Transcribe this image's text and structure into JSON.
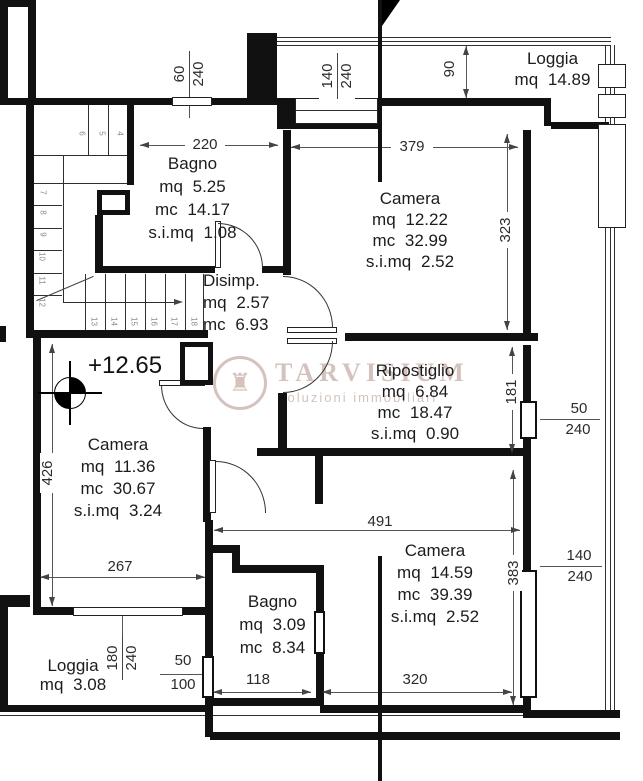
{
  "title": "Floor plan",
  "rooms": {
    "bagno_tl": {
      "name": "Bagno",
      "l1": "mq 5.25",
      "l2": "mc 14.17",
      "l3": "s.i.mq 1.08"
    },
    "camera_tr": {
      "name": "Camera",
      "l1": "mq 12.22",
      "l2": "mc 32.99",
      "l3": "s.i.mq 2.52"
    },
    "disimp": {
      "name": "Disimp.",
      "l1": "mq 2.57",
      "l2": "mc 6.93"
    },
    "ripostiglio": {
      "name": "Ripostiglio",
      "l1": "mq 6.84",
      "l2": "mc 18.47",
      "l3": "s.i.mq 0.90"
    },
    "camera_bl": {
      "name": "Camera",
      "l1": "mq 11.36",
      "l2": "mc 30.67",
      "l3": "s.i.mq 3.24"
    },
    "camera_br": {
      "name": "Camera",
      "l1": "mq 14.59",
      "l2": "mc 39.39",
      "l3": "s.i.mq 2.52"
    },
    "bagno_b": {
      "name": "Bagno",
      "l1": "mq 3.09",
      "l2": "mc 8.34"
    },
    "loggia_tr": {
      "name": "Loggia",
      "l1": "mq 14.89"
    },
    "loggia_bl": {
      "name": "Loggia",
      "l1": "mq 3.08"
    }
  },
  "level_marker": "+12.65",
  "dims": {
    "d220": "220",
    "d379": "379",
    "d90": "90",
    "d323": "323",
    "d181": "181",
    "d426": "426",
    "d267": "267",
    "d491": "491",
    "d383": "383",
    "d118": "118",
    "d320": "320",
    "f60_240": {
      "n": "60",
      "d": "240"
    },
    "f140_240_top": {
      "n": "140",
      "d": "240"
    },
    "f50_240": {
      "n": "50",
      "d": "240"
    },
    "f140_240_right": {
      "n": "140",
      "d": "240"
    },
    "f180_240": {
      "n": "180",
      "d": "240"
    },
    "f50_100": {
      "n": "50",
      "d": "100"
    }
  },
  "stairs": {
    "top": [
      "6",
      "5",
      "4"
    ],
    "left": [
      "7",
      "8",
      "9",
      "10",
      "11",
      "12"
    ],
    "bottom": [
      "13",
      "14",
      "15",
      "16",
      "17",
      "18"
    ]
  },
  "watermark": {
    "title": "TARVISIUM",
    "subtitle": "soluzioni immobiliari",
    "icon": "castle-logo"
  },
  "colors": {
    "wall": "#111111",
    "dimension": "#555555",
    "watermark": "#a8887c"
  }
}
